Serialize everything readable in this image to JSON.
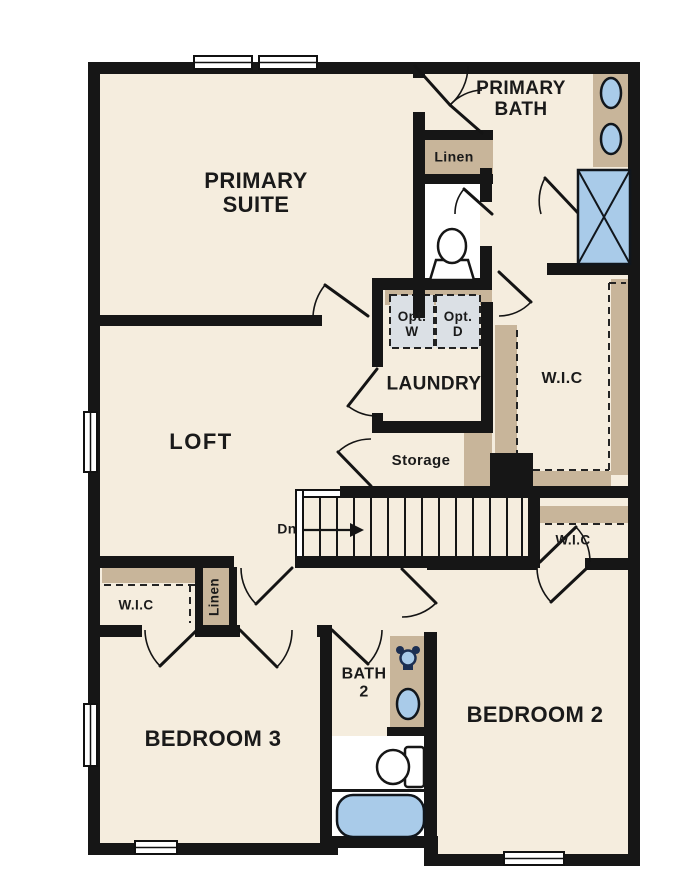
{
  "title": "Second floor plan",
  "colors": {
    "floor": "#f5edde",
    "wall": "#161616",
    "casework": "#c8b59a",
    "fixture_blue": "#a9cbe9",
    "appliance_gray": "#dbe0e5",
    "text": "#1a1a1a",
    "bg": "#ffffff",
    "fixture_dark": "#1c2f52"
  },
  "rooms": {
    "primary_suite": [
      "PRIMARY",
      "SUITE"
    ],
    "primary_bath": [
      "PRIMARY",
      "BATH"
    ],
    "loft": "LOFT",
    "linen_bath": "Linen",
    "laundry": "LAUNDRY",
    "opt_washer": [
      "Opt.",
      "W"
    ],
    "opt_dryer": [
      "Opt.",
      "D"
    ],
    "wic_primary": "W.I.C",
    "storage": "Storage",
    "stair_direction": "Dn",
    "wic_hall": "W.I.C",
    "wic_bedroom3": "W.I.C",
    "linen_hall": "Linen",
    "bath2": [
      "BATH",
      "2"
    ],
    "bedroom3": "BEDROOM 3",
    "bedroom2": "BEDROOM 2"
  },
  "fixtures": [
    "dual-vanity-sinks",
    "shower",
    "toilet-primary",
    "optional-washer",
    "optional-dryer",
    "bath2-vanity-sink",
    "bath2-faucet",
    "toilet-bath2",
    "bathtub",
    "stairs-down"
  ]
}
